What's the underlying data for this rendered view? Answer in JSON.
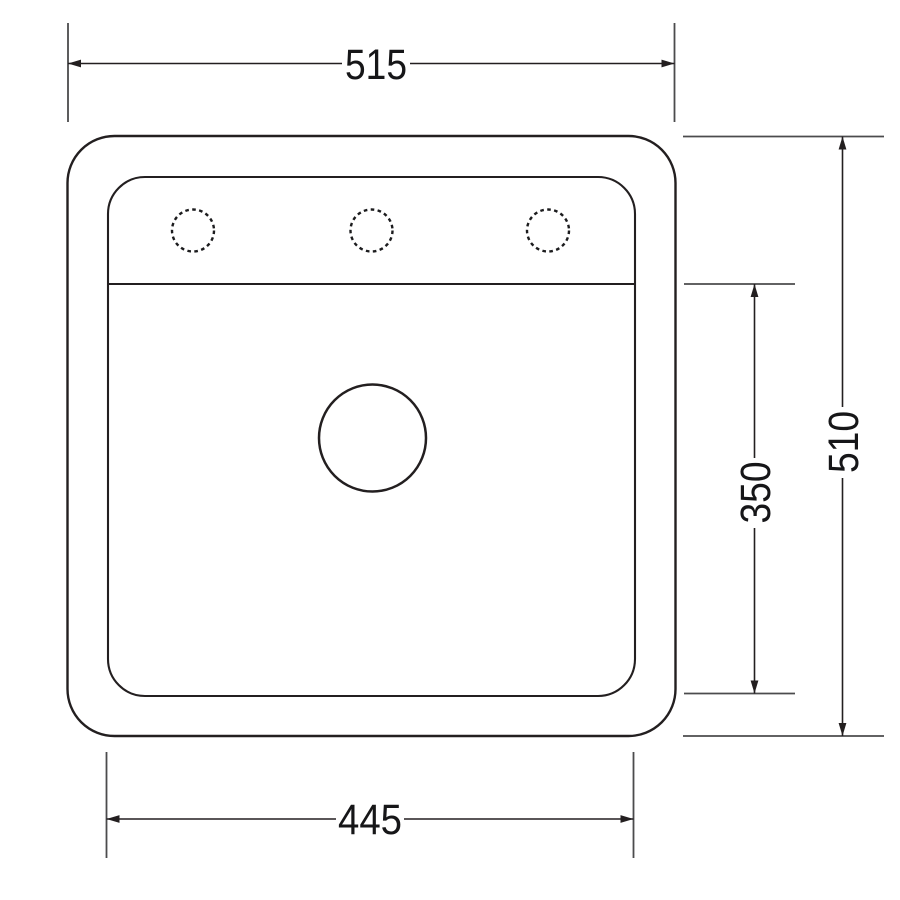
{
  "drawing": {
    "colors": {
      "background": "#ffffff",
      "line": "#231f20",
      "extension_line": "#4b4b4d",
      "label_text": "#161618"
    },
    "dimension_labels": {
      "overall_width": "515",
      "overall_depth": "510",
      "bowl_width": "445",
      "bowl_depth": "350"
    }
  }
}
